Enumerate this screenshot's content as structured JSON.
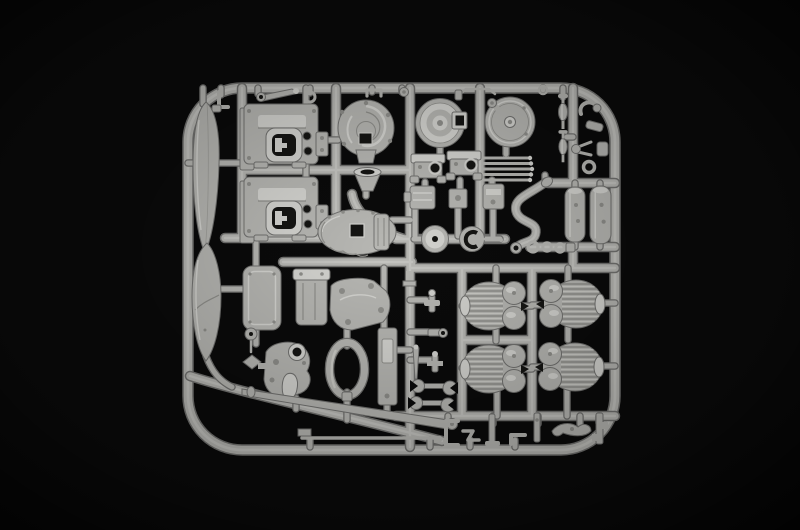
{
  "scene": {
    "type": "photograph",
    "subject": "Light grey plastic model-kit sprue with unassembled motorcycle engine and frame parts on a black background",
    "background_description": "black studio backdrop with soft vignette",
    "sprue_color_name": "light grey styrene"
  },
  "colors": {
    "background": "#0a0a0a",
    "plastic-base": "#b7b7b3",
    "plastic-light": "#d4d4d0",
    "plastic-dark": "#8f8f8b",
    "plastic-outline": "#727270",
    "hole-dark": "#151513"
  },
  "inventory": [
    {
      "name": "sprue-frame",
      "count": 1
    },
    {
      "name": "fender-shell-half",
      "count": 2
    },
    {
      "name": "engine-crankcase-half",
      "count": 2
    },
    {
      "name": "timing-cover",
      "count": 1
    },
    {
      "name": "brake-drum",
      "count": 1
    },
    {
      "name": "brake-backing-plate-with-lever",
      "count": 1
    },
    {
      "name": "gearbox-housing",
      "count": 1
    },
    {
      "name": "intake-funnel",
      "count": 1
    },
    {
      "name": "mount-bracket",
      "count": 2
    },
    {
      "name": "small-canister",
      "count": 3
    },
    {
      "name": "push-rod",
      "count": 5
    },
    {
      "name": "axle-spindle",
      "count": 2
    },
    {
      "name": "linkage-fitting",
      "count": 5
    },
    {
      "name": "exhaust-header-pipe",
      "count": 1
    },
    {
      "name": "muffler",
      "count": 2
    },
    {
      "name": "pipe-clamp-ring",
      "count": 3
    },
    {
      "name": "battery-box-lid",
      "count": 1
    },
    {
      "name": "cylinder-barrel",
      "count": 1
    },
    {
      "name": "cylinder-head-cover",
      "count": 1
    },
    {
      "name": "air-filter-ring",
      "count": 1
    },
    {
      "name": "mounting-plate",
      "count": 1
    },
    {
      "name": "carburetor-assembly",
      "count": 1
    },
    {
      "name": "finned-cylinder-head",
      "count": 4
    },
    {
      "name": "control-lever",
      "count": 4
    },
    {
      "name": "tapered-pin",
      "count": 1
    },
    {
      "name": "open-end-wrench",
      "count": 2
    },
    {
      "name": "drive-shaft",
      "count": 1
    },
    {
      "name": "tie-rod",
      "count": 1
    },
    {
      "name": "frame-fitting",
      "count": 7
    },
    {
      "name": "kickstand-blade",
      "count": 1
    },
    {
      "name": "hand-lever",
      "count": 1
    },
    {
      "name": "kick-starter-arm",
      "count": 1
    },
    {
      "name": "cable-ring",
      "count": 2
    },
    {
      "name": "wire-clip",
      "count": 2
    },
    {
      "name": "hub-disc",
      "count": 2
    }
  ]
}
